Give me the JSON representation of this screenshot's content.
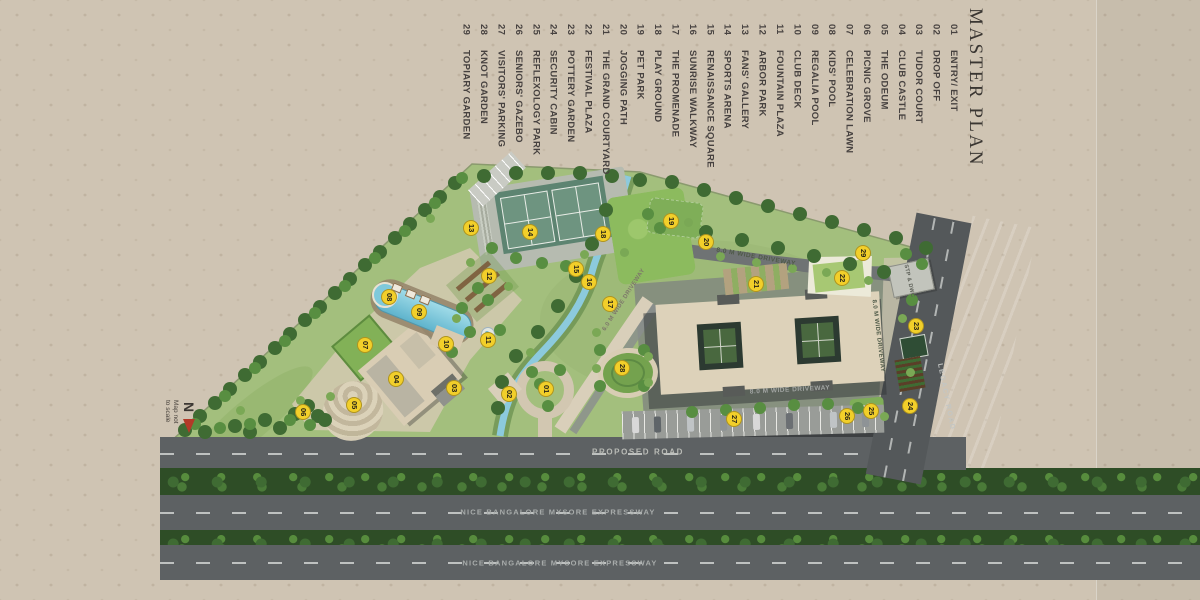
{
  "title": "MASTER PLAN",
  "legend": {
    "items": [
      {
        "no": "01",
        "label": "ENTRY/ EXIT"
      },
      {
        "no": "02",
        "label": "DROP OFF"
      },
      {
        "no": "03",
        "label": "TUDOR COURT"
      },
      {
        "no": "04",
        "label": "CLUB CASTLE"
      },
      {
        "no": "05",
        "label": "THE ODEUM"
      },
      {
        "no": "06",
        "label": "PICNIC GROVE"
      },
      {
        "no": "07",
        "label": "CELEBRATION LAWN"
      },
      {
        "no": "08",
        "label": "KIDS' POOL"
      },
      {
        "no": "09",
        "label": "REGALIA POOL"
      },
      {
        "no": "10",
        "label": "CLUB DECK"
      },
      {
        "no": "11",
        "label": "FOUNTAIN PLAZA"
      },
      {
        "no": "12",
        "label": "ARBOR PARK"
      },
      {
        "no": "13",
        "label": "FANS' GALLERY"
      },
      {
        "no": "14",
        "label": "SPORTS ARENA"
      },
      {
        "no": "15",
        "label": "RENAISSANCE SQUARE"
      },
      {
        "no": "16",
        "label": "SUNRISE WALKWAY"
      },
      {
        "no": "17",
        "label": "THE PROMENADE"
      },
      {
        "no": "18",
        "label": "PLAY GROUND"
      },
      {
        "no": "19",
        "label": "PET PARK"
      },
      {
        "no": "20",
        "label": "JOGGING PATH"
      },
      {
        "no": "21",
        "label": "THE GRAND COURTYARD"
      },
      {
        "no": "22",
        "label": "FESTIVAL PLAZA"
      },
      {
        "no": "23",
        "label": "POTTERY GARDEN"
      },
      {
        "no": "24",
        "label": "SECURITY CABIN"
      },
      {
        "no": "25",
        "label": "REFLEXOLOGY PARK"
      },
      {
        "no": "26",
        "label": "SENIORS' GAZEBO"
      },
      {
        "no": "27",
        "label": "VISITORS' PARKING"
      },
      {
        "no": "28",
        "label": "KNOT GARDEN"
      },
      {
        "no": "29",
        "label": "TOPIARY GARDEN"
      }
    ]
  },
  "compass": {
    "letter": "N",
    "note": "Map not\nto scale"
  },
  "map_labels": [
    {
      "text": "PROPOSED ROAD",
      "x": 638,
      "y": 452,
      "rot": 0,
      "size": 8,
      "ls": 1.6,
      "color": "#b9bbb6"
    },
    {
      "text": "NICE BANGALORE MYSORE EXPRESSWAY",
      "x": 558,
      "y": 512,
      "rot": 0,
      "size": 7.5,
      "ls": 1.2,
      "color": "#a8acab"
    },
    {
      "text": "NICE BANGALORE MYSORE EXPRESSWAY",
      "x": 560,
      "y": 563,
      "rot": 0,
      "size": 7.5,
      "ls": 1.2,
      "color": "#a8acab"
    },
    {
      "text": "LEGACY ROAD",
      "x": 946,
      "y": 397,
      "rot": 79,
      "size": 7,
      "ls": 1.5,
      "color": "#c3c6c4"
    },
    {
      "text": "8.0 M WIDE DRIVEWAY",
      "x": 756,
      "y": 257,
      "rot": 10,
      "size": 6.5,
      "ls": 0.5,
      "color": "#4f5a48"
    },
    {
      "text": "8.0 M WIDE DRIVEWAY",
      "x": 790,
      "y": 390,
      "rot": -3,
      "size": 6.5,
      "ls": 0.5,
      "color": "#a2a5a3"
    },
    {
      "text": "8.0 M WIDE DRIVEWAY",
      "x": 878,
      "y": 336,
      "rot": 83,
      "size": 6,
      "ls": 0.4,
      "color": "#4f5a48"
    },
    {
      "text": "6.0 M WIDE DRIVEWAY",
      "x": 624,
      "y": 300,
      "rot": -57,
      "size": 6,
      "ls": 0.4,
      "color": "#7d766a"
    },
    {
      "text": "STP & DWC",
      "x": 909,
      "y": 281,
      "rot": 78,
      "size": 5.5,
      "ls": 0.3,
      "color": "#5a5d55"
    }
  ],
  "badges": [
    {
      "n": "01",
      "x": 545,
      "y": 388
    },
    {
      "n": "02",
      "x": 508,
      "y": 393
    },
    {
      "n": "03",
      "x": 453,
      "y": 387
    },
    {
      "n": "04",
      "x": 395,
      "y": 378
    },
    {
      "n": "05",
      "x": 353,
      "y": 404
    },
    {
      "n": "06",
      "x": 302,
      "y": 411
    },
    {
      "n": "07",
      "x": 364,
      "y": 344
    },
    {
      "n": "08",
      "x": 388,
      "y": 296
    },
    {
      "n": "09",
      "x": 418,
      "y": 311
    },
    {
      "n": "10",
      "x": 445,
      "y": 343
    },
    {
      "n": "11",
      "x": 487,
      "y": 339
    },
    {
      "n": "12",
      "x": 488,
      "y": 275
    },
    {
      "n": "13",
      "x": 470,
      "y": 227
    },
    {
      "n": "14",
      "x": 529,
      "y": 231
    },
    {
      "n": "15",
      "x": 575,
      "y": 268
    },
    {
      "n": "16",
      "x": 588,
      "y": 281
    },
    {
      "n": "17",
      "x": 609,
      "y": 303
    },
    {
      "n": "18",
      "x": 602,
      "y": 233
    },
    {
      "n": "19",
      "x": 670,
      "y": 220
    },
    {
      "n": "20",
      "x": 705,
      "y": 241
    },
    {
      "n": "21",
      "x": 755,
      "y": 283
    },
    {
      "n": "22",
      "x": 841,
      "y": 277
    },
    {
      "n": "23",
      "x": 915,
      "y": 325
    },
    {
      "n": "24",
      "x": 909,
      "y": 405
    },
    {
      "n": "25",
      "x": 870,
      "y": 410
    },
    {
      "n": "26",
      "x": 846,
      "y": 415
    },
    {
      "n": "27",
      "x": 733,
      "y": 418
    },
    {
      "n": "28",
      "x": 621,
      "y": 367
    },
    {
      "n": "29",
      "x": 862,
      "y": 252
    }
  ],
  "colors": {
    "background": "#cfc4b3",
    "legend_text": "#474240",
    "badge": "#f2cf2a",
    "site_green": "#a3bf7d",
    "road": "#5d6163",
    "water": "#7fc9db",
    "canal": "#b2cabb",
    "north_arrow": "#b23a28"
  }
}
